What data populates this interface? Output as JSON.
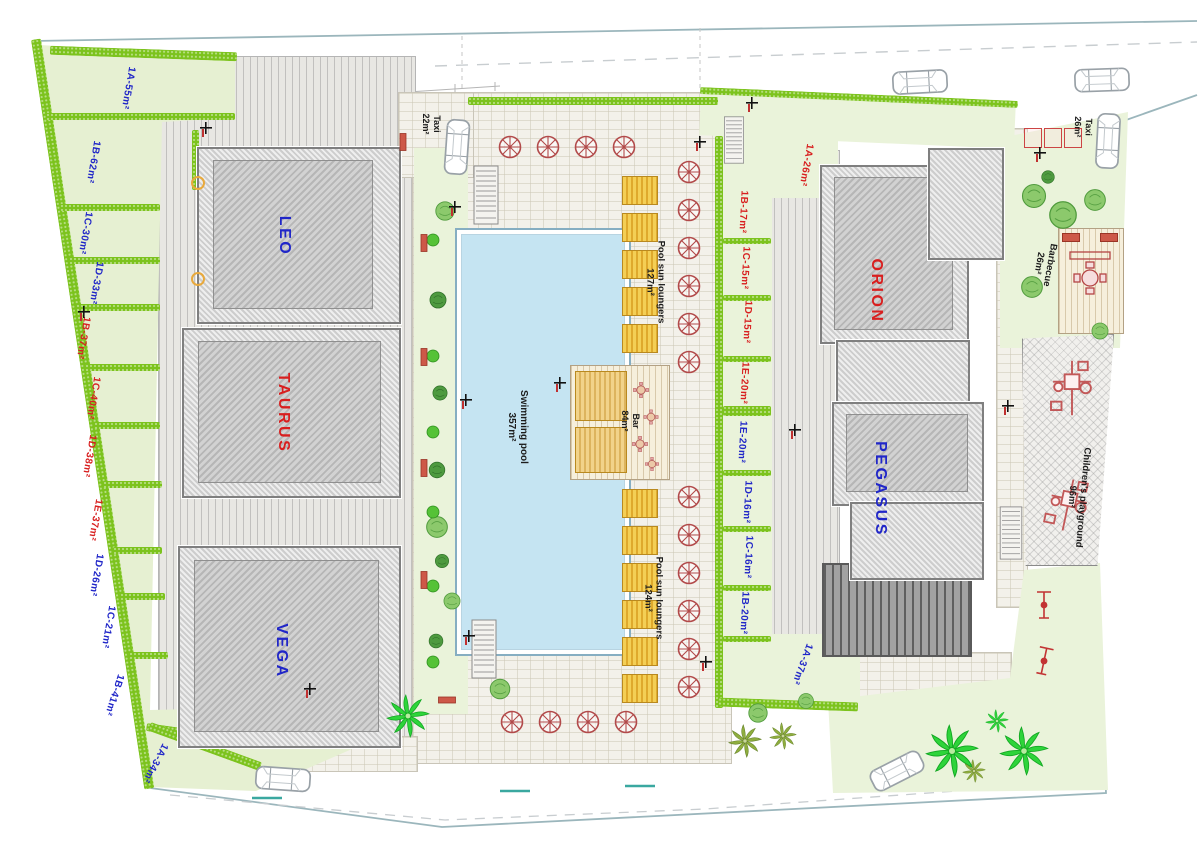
{
  "buildings": [
    {
      "label": "LEO",
      "color": "#2026c8"
    },
    {
      "label": "TAURUS",
      "color": "#d81f1f"
    },
    {
      "label": "VEGA",
      "color": "#2026c8"
    },
    {
      "label": "ORION",
      "color": "#d81f1f"
    },
    {
      "label": "PEGASUS",
      "color": "#2026c8"
    }
  ],
  "left_plots": [
    {
      "label": "1A-55m²",
      "color": "blue"
    },
    {
      "label": "1B-62m²",
      "color": "blue"
    },
    {
      "label": "1C-30m²",
      "color": "blue"
    },
    {
      "label": "1D-33m²",
      "color": "blue"
    },
    {
      "label": "1B-37m²",
      "color": "red"
    },
    {
      "label": "1C-40m²",
      "color": "red"
    },
    {
      "label": "1D-38m²",
      "color": "red"
    },
    {
      "label": "1E-37m²",
      "color": "red"
    },
    {
      "label": "1D-26m²",
      "color": "blue"
    },
    {
      "label": "1C-21m²",
      "color": "blue"
    },
    {
      "label": "1B-41m²",
      "color": "blue"
    },
    {
      "label": "1A-34m²",
      "color": "blue"
    }
  ],
  "right_plots": [
    {
      "label": "1A-26m²",
      "color": "red"
    },
    {
      "label": "1B-17m²",
      "color": "red"
    },
    {
      "label": "1C-15m²",
      "color": "red"
    },
    {
      "label": "1D-15m²",
      "color": "red"
    },
    {
      "label": "1E-20m²",
      "color": "red"
    },
    {
      "label": "1E-20m²",
      "color": "blue"
    },
    {
      "label": "1D-16m²",
      "color": "blue"
    },
    {
      "label": "1C-16m²",
      "color": "blue"
    },
    {
      "label": "1B-20m²",
      "color": "blue"
    },
    {
      "label": "1A-37m²",
      "color": "blue"
    }
  ],
  "amenities": {
    "swimming_pool": {
      "name": "Swimming pool",
      "area": "357m²"
    },
    "loungers_top": {
      "name": "Pool sun loungers",
      "area": "127m²"
    },
    "loungers_bottom": {
      "name": "Pool sun loungers",
      "area": "124m²"
    },
    "bar": {
      "name": "Bar",
      "area": "84m²"
    },
    "taxi_top_left": {
      "name": "Taxi",
      "area": "22m²"
    },
    "taxi_top_right": {
      "name": "Taxi",
      "area": "26m²"
    },
    "barbecue": {
      "name": "Barbecue",
      "area": "26m²"
    },
    "playground": {
      "name": "Children's playground",
      "area": "96m²"
    }
  },
  "colors": {
    "label_blue": "#2026c8",
    "label_red": "#d81f1f",
    "pool": "#c5e4f2",
    "hedge": "#7cc31d",
    "lawn": "#eaf3da",
    "palm": "#2ed43a"
  }
}
